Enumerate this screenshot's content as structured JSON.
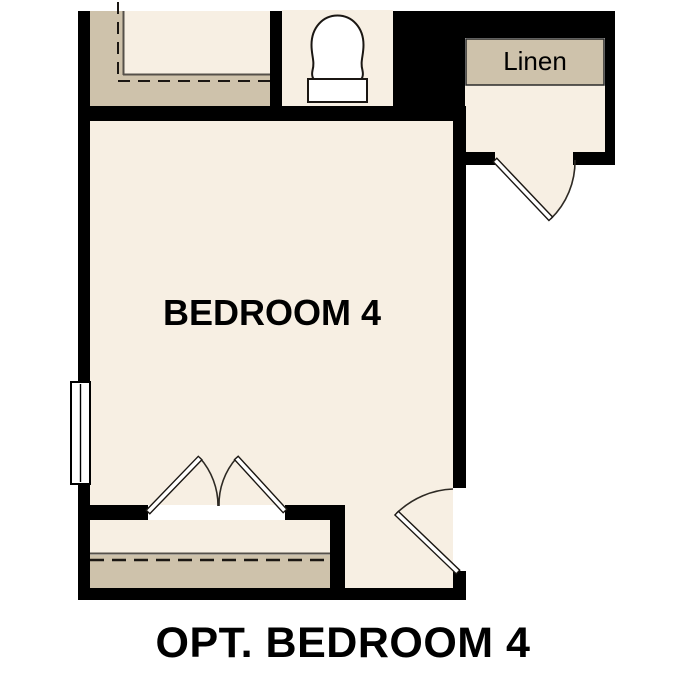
{
  "plan": {
    "bedroom_label": "BEDROOM 4",
    "linen_label": "Linen",
    "caption": "OPT. BEDROOM 4"
  },
  "colors": {
    "floor": "#f7efe3",
    "shelf": "#cec2ab",
    "wall": "#000000",
    "line-dark": "#1b1713",
    "line-gray": "#55504a",
    "fixture": "#ffffff",
    "text": "#000000"
  }
}
